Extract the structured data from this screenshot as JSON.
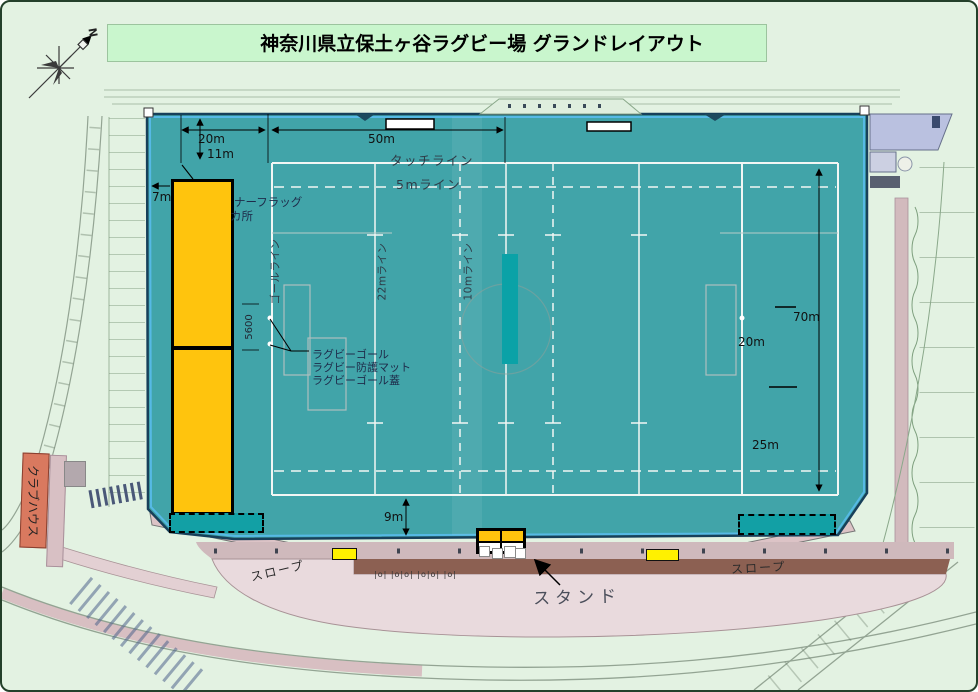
{
  "title": "神奈川県立保土ヶ谷ラグビー場 グランドレイアウト",
  "compass": {
    "north": "N"
  },
  "dims": {
    "m20_top": "20m",
    "m50": "50m",
    "m11": "11m",
    "m7": "7m",
    "m70": "70m",
    "m20_right": "20m",
    "m25": "25m",
    "m9": "9m",
    "goal_5600": "5600"
  },
  "field": {
    "touch_line": "タッチライン",
    "line_5m": "5mライン",
    "goal_line": "ゴールライン",
    "line_22m": "22mライン",
    "line_10m": "10mライン",
    "corner_flag_l1": "ナーフラッグ",
    "corner_flag_l2": "カ所",
    "goal": "ラグビーゴール",
    "mat": "ラグビー防護マット",
    "goal_cover": "ラグビーゴール蓋"
  },
  "site": {
    "stand": "スタンド",
    "slope_left": "スロープ",
    "slope_right": "スロープ",
    "clubhouse": "クラブハウス",
    "bench_row": "|o| |o|o| |o|o| |o|"
  },
  "colors": {
    "field_teal": "#41a4a9",
    "accent_teal_dark": "#0aa2a7",
    "box_yellow": "#ffc40d",
    "small_yellow": "#fff100",
    "stand_brown": "#8c6052",
    "clubhouse_salmon": "#d9795f",
    "title_bg": "#c9f6cd",
    "edge_blue": "#56b9e5"
  }
}
